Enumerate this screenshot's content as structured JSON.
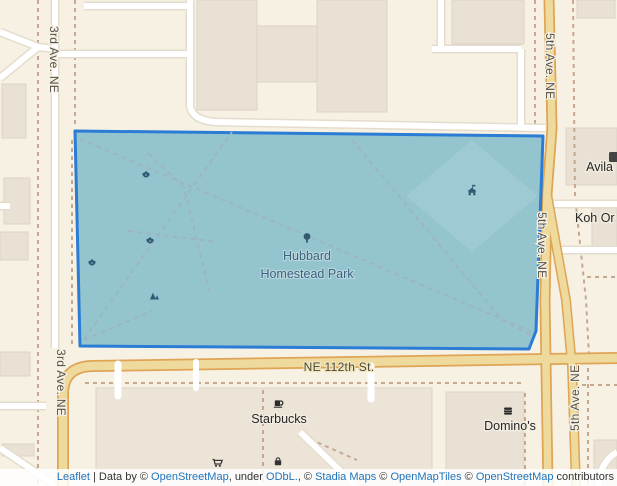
{
  "map": {
    "street_labels": {
      "third_ave_top": "3rd Ave. NE",
      "third_ave_bottom": "3rd Ave. NE",
      "fifth_ave_top": "5th Ave. NE",
      "fifth_ave_mid": "5th Ave. NE",
      "fifth_ave_bottom": "5th Ave. NE",
      "ne_112th": "NE 112th St."
    },
    "park": {
      "name_line1": "Hubbard",
      "name_line2": "Homestead Park"
    },
    "pois": {
      "starbucks": "Starbucks",
      "dominos": "Domino's",
      "avila": "Avila",
      "koh": "Koh Or"
    },
    "icons": {
      "park_flowers": "flower-icon",
      "playground": "playground-icon",
      "shelter": "picnic-shelter-icon",
      "park_tree": "tree-icon",
      "starbucks": "coffee-cup-icon",
      "dominos": "fast-food-icon",
      "cart": "shopping-cart-icon",
      "bag": "shopping-bag-icon",
      "avila": "building-icon"
    },
    "colors": {
      "background": "#f7f1e3",
      "selection_stroke": "#2a7cd5",
      "park_fill": "#94c4ce",
      "road_major_fill": "#eeda9c",
      "road_major_casing": "#dfa455",
      "road_minor_fill": "#ffffff",
      "path_dashed": "#c6a88d",
      "attribution_link": "#1f74bc"
    }
  },
  "attribution": {
    "leaflet": "Leaflet",
    "sep1": " | Data by © ",
    "osm_a": "OpenStreetMap",
    "sep2": ", under ",
    "odbl": "ODbL.",
    "sep3": ", © ",
    "stadia": "Stadia Maps",
    "sep4": " © ",
    "openmaptiles": "OpenMapTiles",
    "sep5": " © ",
    "osm_b": "OpenStreetMap",
    "sep6": " contributors"
  }
}
